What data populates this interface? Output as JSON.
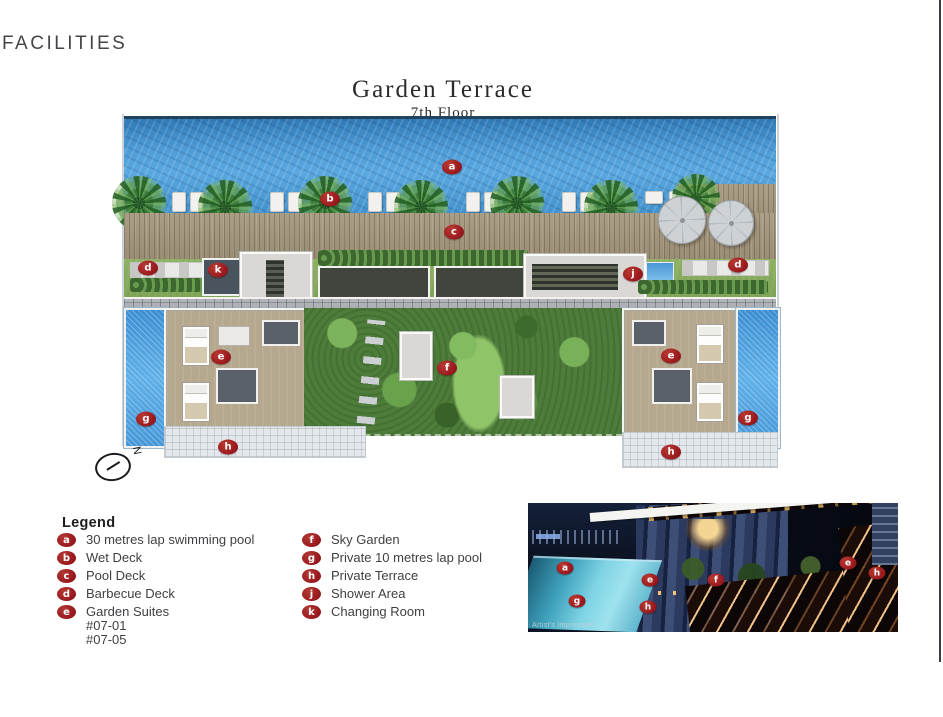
{
  "page": {
    "heading": "FACILITIES",
    "accent_color": "#9a191e"
  },
  "plan": {
    "title": "Garden Terrace",
    "subtitle": "7th Floor",
    "compass_label": "N",
    "markers": [
      {
        "label": "a",
        "x": 452,
        "y": 167
      },
      {
        "label": "b",
        "x": 330,
        "y": 199
      },
      {
        "label": "c",
        "x": 454,
        "y": 232
      },
      {
        "label": "d",
        "x": 148,
        "y": 268
      },
      {
        "label": "k",
        "x": 218,
        "y": 270
      },
      {
        "label": "j",
        "x": 633,
        "y": 274
      },
      {
        "label": "d",
        "x": 738,
        "y": 265
      },
      {
        "label": "e",
        "x": 221,
        "y": 357
      },
      {
        "label": "f",
        "x": 447,
        "y": 368
      },
      {
        "label": "e",
        "x": 671,
        "y": 356
      },
      {
        "label": "g",
        "x": 146,
        "y": 419
      },
      {
        "label": "g",
        "x": 748,
        "y": 418
      },
      {
        "label": "h",
        "x": 228,
        "y": 447
      },
      {
        "label": "h",
        "x": 671,
        "y": 452
      }
    ]
  },
  "legend": {
    "title": "Legend",
    "columns": [
      {
        "items": [
          {
            "label": "a",
            "text": "30 metres lap swimming pool"
          },
          {
            "label": "b",
            "text": "Wet Deck"
          },
          {
            "label": "c",
            "text": "Pool Deck"
          },
          {
            "label": "d",
            "text": "Barbecue Deck"
          },
          {
            "label": "e",
            "text": "Garden Suites",
            "extra": [
              "#07-01",
              "#07-05"
            ]
          }
        ]
      },
      {
        "items": [
          {
            "label": "f",
            "text": "Sky Garden"
          },
          {
            "label": "g",
            "text": "Private 10 metres lap pool"
          },
          {
            "label": "h",
            "text": "Private Terrace"
          },
          {
            "label": "j",
            "text": "Shower Area"
          },
          {
            "label": "k",
            "text": "Changing Room"
          }
        ]
      }
    ]
  },
  "photo": {
    "caption": "Artist's Impression",
    "markers": [
      {
        "label": "a",
        "x": 565,
        "y": 568
      },
      {
        "label": "e",
        "x": 650,
        "y": 580
      },
      {
        "label": "f",
        "x": 716,
        "y": 580
      },
      {
        "label": "e",
        "x": 848,
        "y": 563
      },
      {
        "label": "h",
        "x": 877,
        "y": 573
      },
      {
        "label": "g",
        "x": 577,
        "y": 601
      },
      {
        "label": "h",
        "x": 648,
        "y": 607
      }
    ]
  }
}
